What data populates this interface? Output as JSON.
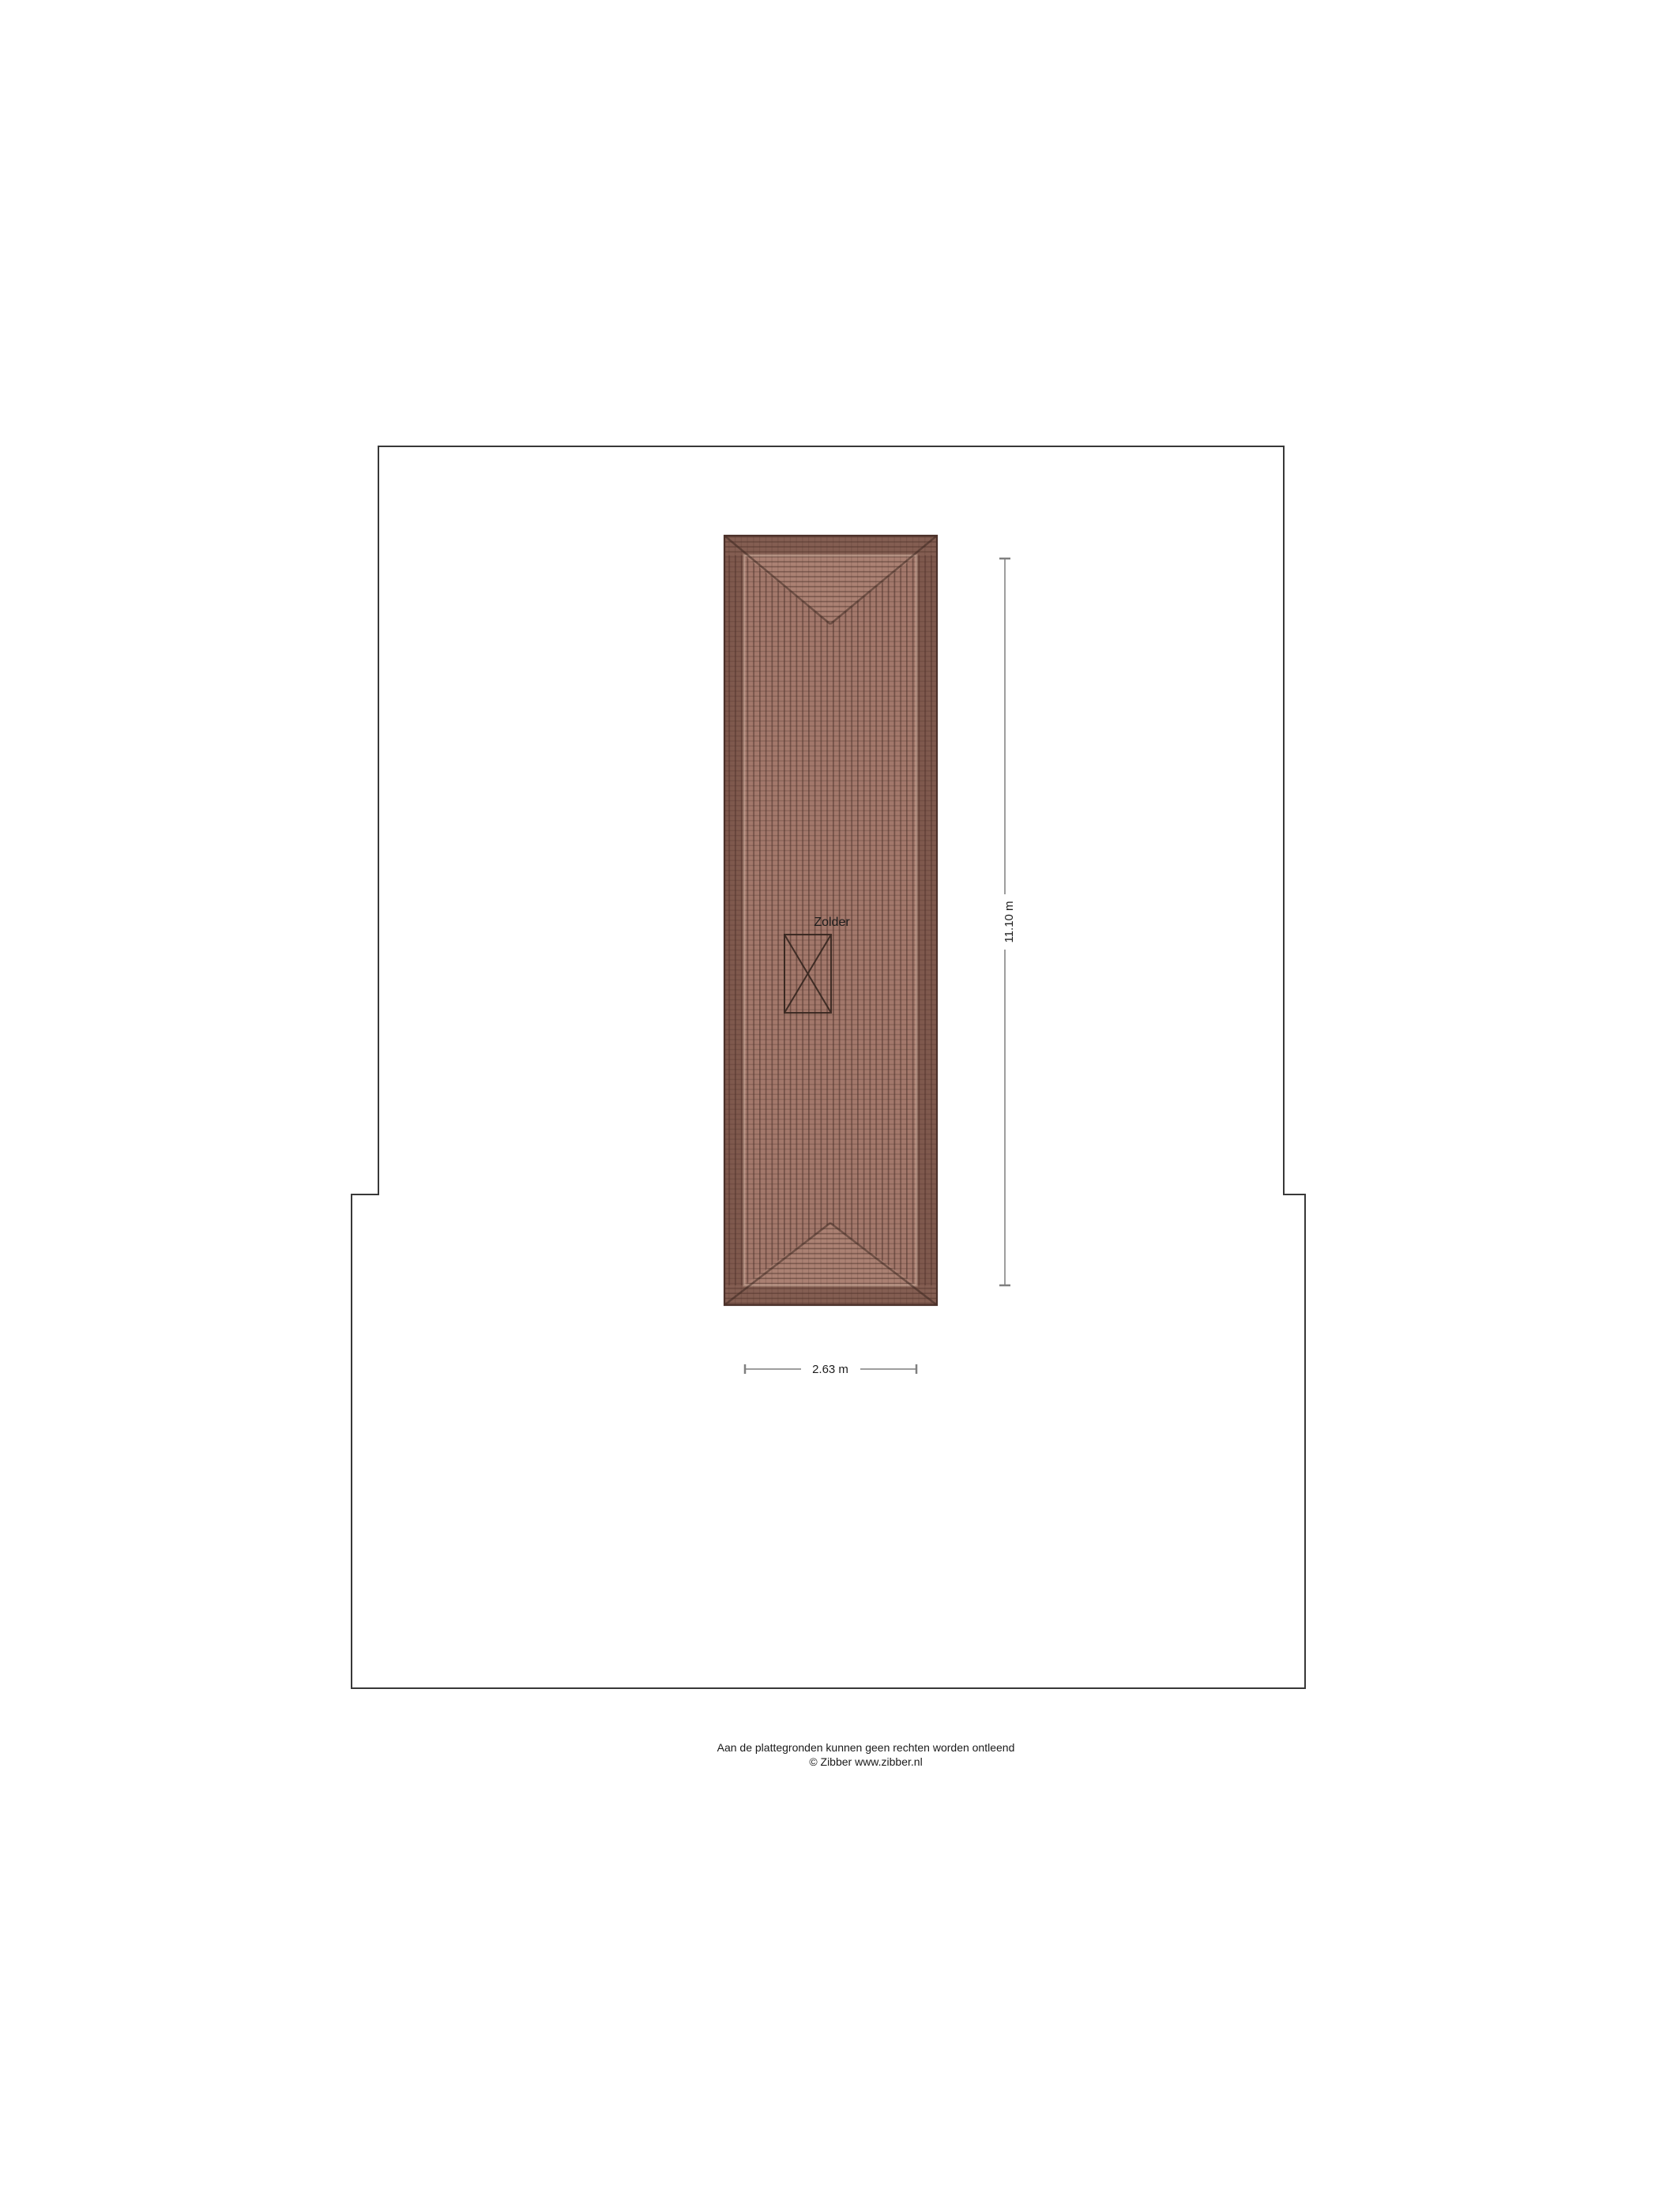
{
  "page": {
    "background": "#ffffff",
    "footer": {
      "disclaimer": "Aan de plattegronden kunnen geen rechten worden ontleend",
      "copyright": "© Zibber www.zibber.nl"
    }
  },
  "floorplan": {
    "floor_name": "Zolder",
    "room_label": "Zolder",
    "dimension_height": "11.10 m",
    "dimension_width": "2.63 m",
    "colors": {
      "wall_outline": "#383838",
      "dimension_line": "#7f7f7f",
      "label_text": "#1c1c1c",
      "roof_tile": "#a3786b",
      "roof_tile_end": "#ab8173",
      "roof_line": "#4b312a",
      "roof_band_shade": "#54342a",
      "roof_ridge": "#38241d",
      "roof_inner_edge_highlight": "#e8cdbc",
      "stair_line": "#2f211b"
    }
  }
}
